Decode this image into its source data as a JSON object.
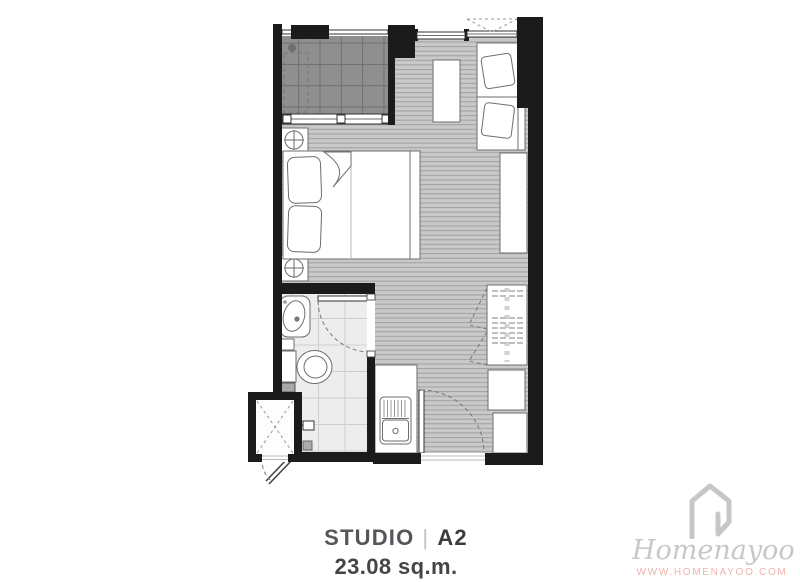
{
  "colors": {
    "wall": "#1b1b1b",
    "wood-floor": "#c9c9c9",
    "wood-line": "#a3a3a3",
    "balcony-tile": "#8f8f8f",
    "balcony-line": "#6f6f6f",
    "bath-tile": "#ededed",
    "bath-line": "#cfcfcf",
    "outline": "#6e6e6e",
    "text-gray": "#55565a",
    "text-dark": "#454548",
    "logo-gray": "#c7c7c7",
    "url-pink": "#efb3ad"
  },
  "plan": {
    "unit_type": "STUDIO",
    "divider": "|",
    "unit_code": "A2",
    "area": "23.08 sq.m."
  },
  "branding": {
    "logo_text": "Homenayoo",
    "website": "WWW.HOMENAYOO.COM",
    "house_icon": "house-outline-icon"
  }
}
